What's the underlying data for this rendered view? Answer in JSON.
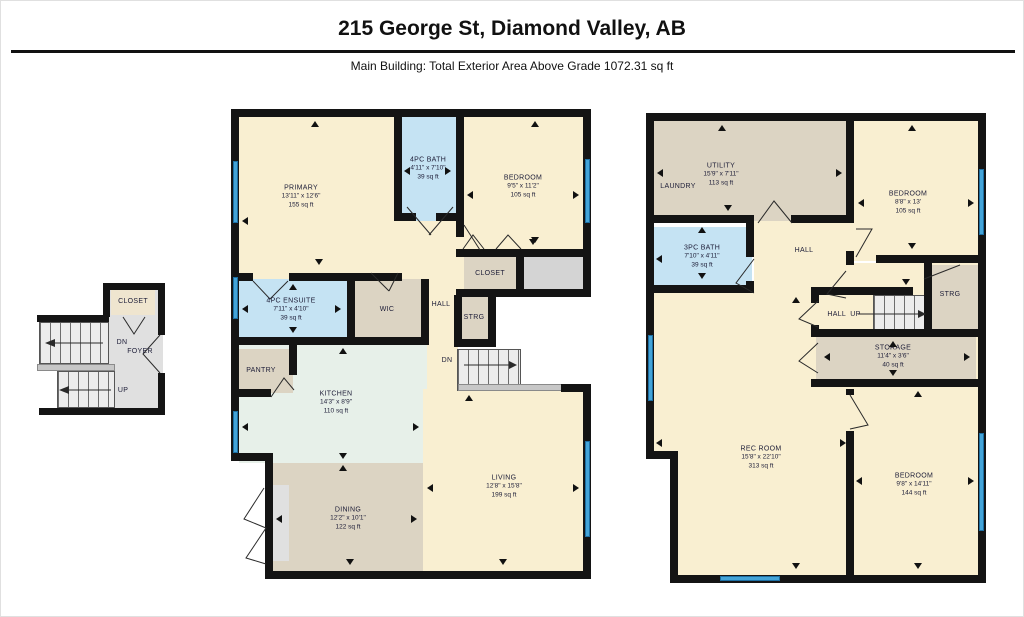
{
  "header": {
    "title": "215 George St, Diamond Valley, AB",
    "subtitle": "Main Building: Total Exterior Area Above Grade 1072.31 sq ft"
  },
  "colors": {
    "wall": "#141414",
    "room_cream": "#f9efd1",
    "bath_blue": "#c5e3f3",
    "utility_tan": "#dcd4c3",
    "kitchen_mint": "#e7f0e9",
    "hall_grey": "#e0e0e0",
    "window_blue": "#44a4d8"
  },
  "foyer_detail": {
    "closet": "CLOSET",
    "dn": "DN",
    "foyer": "FOYER",
    "up": "UP"
  },
  "main_floor": {
    "primary": {
      "name": "PRIMARY",
      "dims": "13'11\" x 12'6\"",
      "area": "155 sq ft"
    },
    "bath4pc": {
      "name": "4PC BATH",
      "dims": "4'11\" x 7'10\"",
      "area": "39 sq ft"
    },
    "bedroom": {
      "name": "BEDROOM",
      "dims": "9'5\" x 11'2\"",
      "area": "105 sq ft"
    },
    "closet": {
      "name": "CLOSET"
    },
    "ensuite": {
      "name": "4PC ENSUITE",
      "dims": "7'11\" x 4'10\"",
      "area": "39 sq ft"
    },
    "wic": {
      "name": "WIC"
    },
    "hall": {
      "name": "HALL"
    },
    "strg": {
      "name": "STRG"
    },
    "dn": {
      "name": "DN"
    },
    "pantry": {
      "name": "PANTRY"
    },
    "kitchen": {
      "name": "KITCHEN",
      "dims": "14'3\" x 8'9\"",
      "area": "110 sq ft"
    },
    "dining": {
      "name": "DINING",
      "dims": "12'2\" x 10'1\"",
      "area": "122 sq ft"
    },
    "living": {
      "name": "LIVING",
      "dims": "12'8\" x 15'8\"",
      "area": "199 sq ft"
    }
  },
  "lower_floor": {
    "utility": {
      "name": "UTILITY",
      "dims": "15'9\" x 7'11\"",
      "area": "113 sq ft"
    },
    "laundry": {
      "name": "LAUNDRY"
    },
    "bedroom_top": {
      "name": "BEDROOM",
      "dims": "8'8\" x 13'",
      "area": "105 sq ft"
    },
    "bath3pc": {
      "name": "3PC BATH",
      "dims": "7'10\" x 4'11\"",
      "area": "39 sq ft"
    },
    "hall": {
      "name": "HALL"
    },
    "strg": {
      "name": "STRG"
    },
    "hall_up": {
      "name": "HALL  UP"
    },
    "storage": {
      "name": "STORAGE",
      "dims": "11'4\" x 3'6\"",
      "area": "40 sq ft"
    },
    "rec_room": {
      "name": "REC ROOM",
      "dims": "15'8\" x 22'10\"",
      "area": "313 sq ft"
    },
    "bedroom_bottom": {
      "name": "BEDROOM",
      "dims": "9'8\" x 14'11\"",
      "area": "144 sq ft"
    }
  }
}
